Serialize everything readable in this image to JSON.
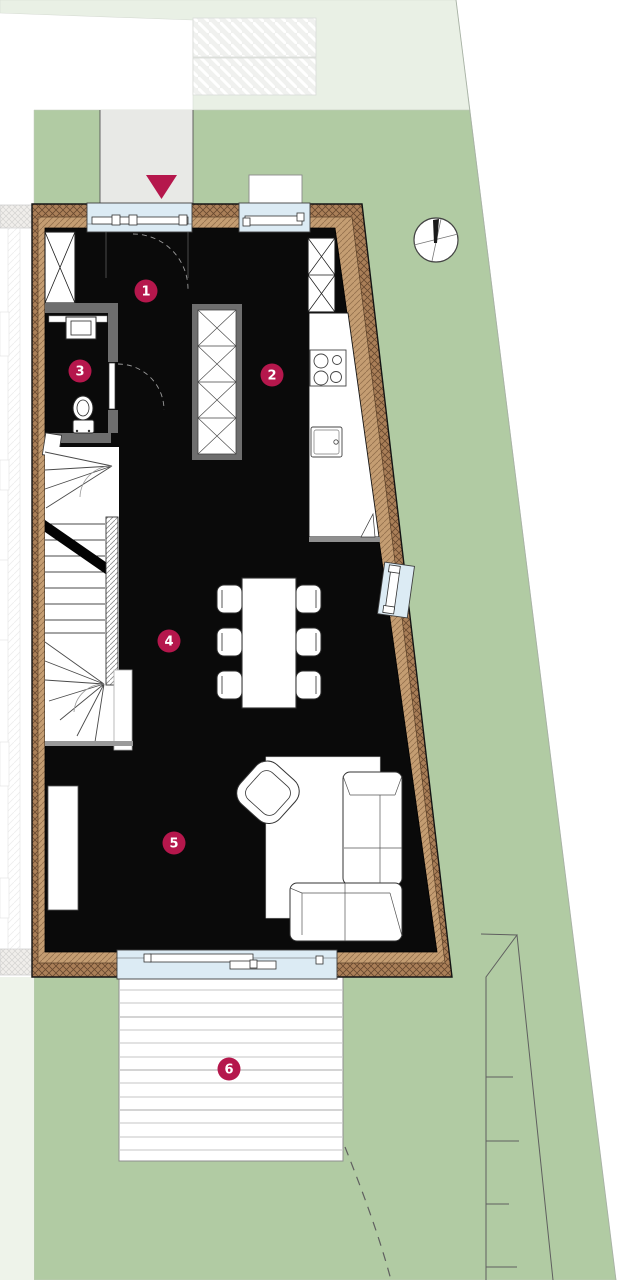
{
  "plan": {
    "markers": [
      {
        "label": "1",
        "x": 146,
        "y": 291
      },
      {
        "label": "2",
        "x": 272,
        "y": 375
      },
      {
        "label": "3",
        "x": 80,
        "y": 371
      },
      {
        "label": "4",
        "x": 169,
        "y": 641
      },
      {
        "label": "5",
        "x": 174,
        "y": 843
      },
      {
        "label": "6",
        "x": 229,
        "y": 1069
      }
    ],
    "colors": {
      "accent": "#b5174c",
      "site_green": "#b1cba3",
      "site_green_pale": "#e9f0e5",
      "path_gray": "#e8e9e6",
      "wall_brown": "#aa7f58",
      "wall_tan": "#c49d72",
      "glazing_blue": "#dcebf4",
      "interior_black": "#0a0a0a",
      "deck_white": "#ffffff"
    }
  }
}
